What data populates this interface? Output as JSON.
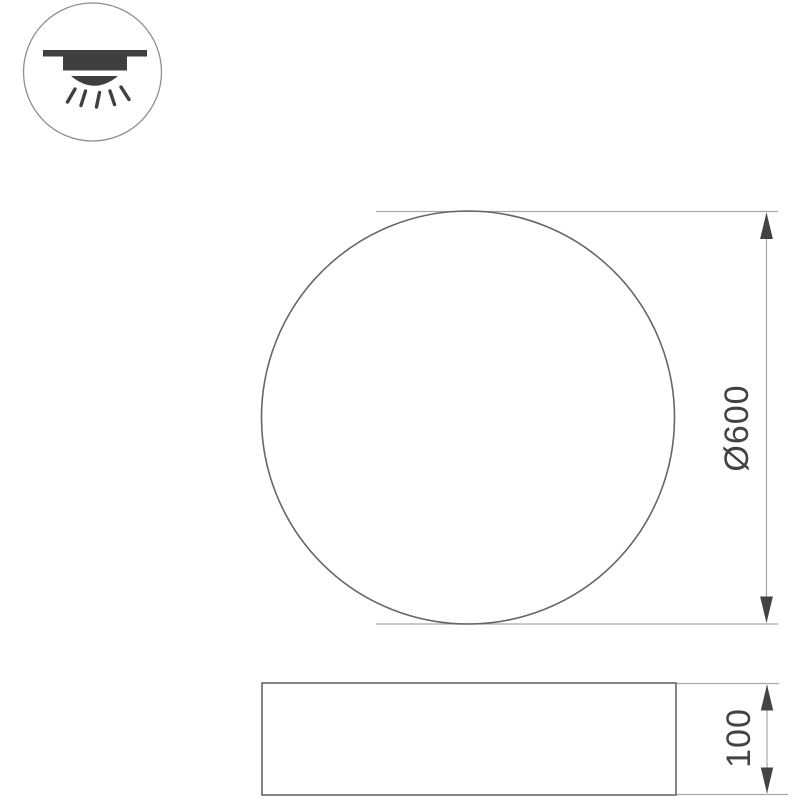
{
  "colors": {
    "background": "#ffffff",
    "ink": "#434343",
    "shape_outline": "#666666",
    "guide_line": "#a8a8a8",
    "icon_ring": "#8f8f8f",
    "icon_glyph": "#3f3f3f"
  },
  "icon": {
    "name": "surface-mounted-ceiling-light-icon"
  },
  "top_view": {
    "shape": "circle",
    "dimension_label": "Ø600"
  },
  "side_view": {
    "shape": "rectangle",
    "dimension_label": "100"
  }
}
